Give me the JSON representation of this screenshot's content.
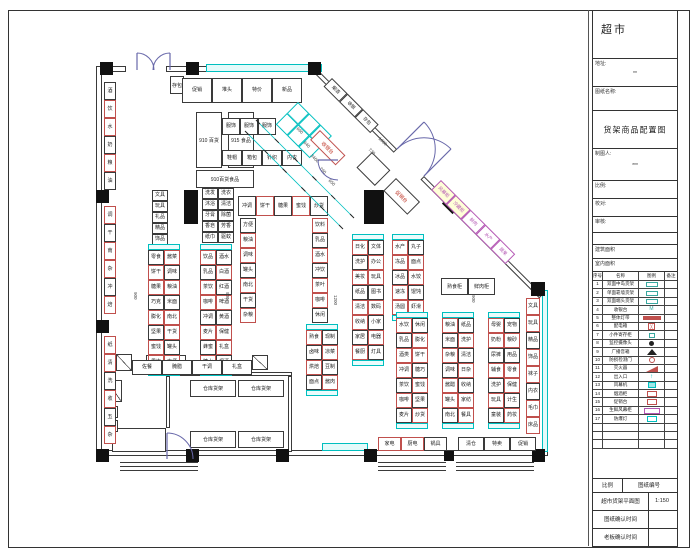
{
  "colors": {
    "black_line": "#3a3a3a",
    "red_line": "#c0504d",
    "cyan_line": "#00bfbf",
    "magenta_line": "#b457b4",
    "door_arc": "#6868aa",
    "red_text": "#c0392b",
    "yellow_fill": "#ffffd8"
  },
  "title_block": {
    "title": "超市",
    "addr_label": "地址:",
    "addr_value": "**",
    "name_label": "图纸名称:",
    "main_title": "货架商品配置图",
    "maker_label": "制图人:",
    "maker_value": "***",
    "scale_label": "比例:",
    "proof_label": "校对:",
    "audit_label": "审核:",
    "area1_label": "建筑面积",
    "area2_label": "室内面积",
    "legend_header": [
      "序号",
      "名称",
      "图例",
      "备注"
    ],
    "legend_rows": [
      {
        "no": "1",
        "name": "双面中岛货架",
        "sym": "trect",
        "note": ""
      },
      {
        "no": "2",
        "name": "单面靠墙货架",
        "sym": "trect",
        "note": ""
      },
      {
        "no": "3",
        "name": "双面端头货架",
        "sym": "trect",
        "note": ""
      },
      {
        "no": "4",
        "name": "收银台",
        "sym": "tword",
        "note": ""
      },
      {
        "no": "5",
        "name": "整体灯带",
        "sym": "rbar",
        "note": ""
      },
      {
        "no": "6",
        "name": "配电箱",
        "sym": "rgrid",
        "note": ""
      },
      {
        "no": "7",
        "name": "小件寄存柜",
        "sym": "tglyph",
        "note": ""
      },
      {
        "no": "8",
        "name": "监控摄像头",
        "sym": "dot",
        "note": ""
      },
      {
        "no": "9",
        "name": "广播音箱",
        "sym": "tri",
        "note": ""
      },
      {
        "no": "10",
        "name": "防损检测门",
        "sym": "rcirc",
        "note": ""
      },
      {
        "no": "11",
        "name": "灭火器",
        "sym": "rflag",
        "note": ""
      },
      {
        "no": "12",
        "name": "出入口",
        "sym": "carrow",
        "note": ""
      },
      {
        "no": "13",
        "name": "风幕机",
        "sym": "cfill",
        "note": ""
      },
      {
        "no": "14",
        "name": "烟酒柜",
        "sym": "rrect",
        "note": ""
      },
      {
        "no": "15",
        "name": "促销台",
        "sym": "rrect",
        "note": ""
      },
      {
        "no": "16",
        "name": "生鲜风幕柜",
        "sym": "mrect",
        "note": ""
      },
      {
        "no": "17",
        "name": "防爆灯",
        "sym": "crect",
        "note": ""
      },
      {
        "no": "",
        "name": "",
        "sym": "none",
        "note": ""
      },
      {
        "no": "",
        "name": "",
        "sym": "none",
        "note": ""
      },
      {
        "no": "",
        "name": "",
        "sym": "none",
        "note": ""
      }
    ],
    "footer_rows": [
      {
        "cells": [
          "比例",
          "图纸编号"
        ],
        "h": 14,
        "split": 30
      },
      {
        "cells": [
          "超市货架平面图",
          "1:150"
        ],
        "h": 18,
        "split": 56
      },
      {
        "cells": [
          "图纸确认时间",
          ""
        ],
        "h": 18,
        "split": 56
      },
      {
        "cells": [
          "老板确认时间",
          ""
        ],
        "h": 18,
        "split": 56
      }
    ]
  },
  "plan": {
    "walls": [
      {
        "x": 100,
        "y": 66,
        "w": 26,
        "h": 6
      },
      {
        "x": 166,
        "y": 66,
        "w": 156,
        "h": 6
      },
      {
        "x": 96,
        "y": 66,
        "w": 6,
        "h": 396
      },
      {
        "x": 96,
        "y": 450,
        "w": 452,
        "h": 6
      },
      {
        "x": 168,
        "y": 372,
        "w": 124,
        "h": 4
      },
      {
        "x": 166,
        "y": 376,
        "w": 4,
        "h": 52
      },
      {
        "x": 288,
        "y": 376,
        "w": 4,
        "h": 76
      },
      {
        "x": 112,
        "y": 428,
        "w": 54,
        "h": 24
      }
    ],
    "cyan_walls": [
      {
        "x": 206,
        "y": 64,
        "w": 116,
        "h": 8
      },
      {
        "x": 542,
        "y": 290,
        "w": 6,
        "h": 162
      },
      {
        "x": 322,
        "y": 443,
        "w": 46,
        "h": 8
      }
    ],
    "diag_walls": [
      {
        "x": 318,
        "y": 70,
        "len": 112,
        "th": 5,
        "rot": 45
      },
      {
        "x": 424,
        "y": 176,
        "len": 168,
        "th": 5,
        "rot": 45
      }
    ],
    "columns": [
      {
        "x": 100,
        "y": 62,
        "s": 13
      },
      {
        "x": 186,
        "y": 62,
        "s": 13
      },
      {
        "x": 308,
        "y": 62,
        "s": 13
      },
      {
        "x": 96,
        "y": 190,
        "s": 13
      },
      {
        "x": 96,
        "y": 320,
        "s": 13
      },
      {
        "x": 96,
        "y": 449,
        "s": 13
      },
      {
        "x": 186,
        "y": 449,
        "s": 13
      },
      {
        "x": 276,
        "y": 449,
        "s": 13
      },
      {
        "x": 364,
        "y": 449,
        "s": 13
      },
      {
        "x": 444,
        "y": 451,
        "s": 10
      },
      {
        "x": 532,
        "y": 449,
        "s": 13
      },
      {
        "x": 531,
        "y": 282,
        "s": 14
      }
    ],
    "diamonds": [
      {
        "x": 445,
        "y": 196,
        "s": 15
      }
    ],
    "pillars": [
      {
        "x": 184,
        "y": 190,
        "w": 14,
        "h": 34
      },
      {
        "x": 364,
        "y": 190,
        "w": 20,
        "h": 34
      }
    ],
    "boxes": [
      {
        "x": 196,
        "y": 112,
        "w": 26,
        "h": 56,
        "t": "910 百货",
        "b": "k"
      },
      {
        "x": 228,
        "y": 112,
        "w": 26,
        "h": 56,
        "t": "915 食品",
        "b": "k"
      },
      {
        "x": 196,
        "y": 170,
        "w": 58,
        "h": 18,
        "t": "910百货食品",
        "b": "k"
      },
      {
        "x": 170,
        "y": 76,
        "w": 14,
        "h": 18,
        "t": "存包",
        "b": "k"
      },
      {
        "x": 190,
        "y": 380,
        "w": 46,
        "h": 17,
        "t": "仓库货架",
        "b": "k"
      },
      {
        "x": 238,
        "y": 380,
        "w": 46,
        "h": 17,
        "t": "仓库货架",
        "b": "k"
      },
      {
        "x": 190,
        "y": 431,
        "w": 46,
        "h": 17,
        "t": "仓库货架",
        "b": "k"
      },
      {
        "x": 238,
        "y": 431,
        "w": 46,
        "h": 17,
        "t": "仓库货架",
        "b": "k"
      },
      {
        "x": 441,
        "y": 278,
        "w": 27,
        "h": 17,
        "t": "熟食柜",
        "b": "k"
      },
      {
        "x": 468,
        "y": 278,
        "w": 27,
        "h": 17,
        "t": "鲜肉柜",
        "b": "k"
      },
      {
        "x": 146,
        "y": 355,
        "w": 40,
        "h": 15,
        "t": "操作台",
        "b": "k"
      },
      {
        "x": 104,
        "y": 406,
        "w": 14,
        "h": 12,
        "t": "",
        "b": "k"
      },
      {
        "x": 104,
        "y": 420,
        "w": 14,
        "h": 12,
        "t": "",
        "b": "k"
      }
    ],
    "xboxes": [
      {
        "x": 116,
        "y": 354,
        "w": 16,
        "h": 17
      },
      {
        "x": 106,
        "y": 380,
        "w": 16,
        "h": 22
      },
      {
        "x": 252,
        "y": 355,
        "w": 16,
        "h": 15
      }
    ],
    "runs": [
      {
        "x": 104,
        "y": 82,
        "d": "v",
        "cw": 12,
        "ch": 18,
        "l": [
          "酒",
          "饮",
          "水",
          "奶",
          "粮",
          "油"
        ],
        "k": "krrkrk"
      },
      {
        "x": 104,
        "y": 206,
        "d": "v",
        "cw": 12,
        "ch": 18,
        "l": [
          "调",
          "干",
          "南",
          "杂",
          "冲",
          "焙"
        ],
        "k": "rkrrkr"
      },
      {
        "x": 104,
        "y": 336,
        "d": "v",
        "cw": 12,
        "ch": 18,
        "l": [
          "纸",
          "清",
          "洗",
          "收",
          "五",
          "杂"
        ],
        "k": "rrkrkr"
      },
      {
        "x": 526,
        "y": 298,
        "d": "v",
        "cw": 14,
        "ch": 17,
        "l": [
          "文具",
          "玩具",
          "精品",
          "饰品",
          "袜子",
          "内衣",
          "毛巾",
          "床品"
        ],
        "k": "rrkrrkrr"
      },
      {
        "x": 182,
        "y": 78,
        "d": "h",
        "cw": 30,
        "ch": 25,
        "l": [
          "促销",
          "堆头",
          "特价",
          "新品"
        ],
        "k": "kkkk"
      },
      {
        "x": 222,
        "y": 118,
        "d": "h",
        "cw": 18,
        "ch": 17,
        "l": [
          "服饰",
          "服饰",
          "服饰"
        ],
        "k": "kkk"
      },
      {
        "x": 222,
        "y": 150,
        "d": "h",
        "cw": 20,
        "ch": 16,
        "l": [
          "鞋帽",
          "箱包",
          "针织",
          "内衣"
        ],
        "k": "kkkk"
      },
      {
        "x": 152,
        "y": 190,
        "d": "v",
        "cw": 16,
        "ch": 11,
        "l": [
          "文具",
          "玩具",
          "礼品",
          "精品",
          "饰品"
        ],
        "k": "kkkkk"
      },
      {
        "x": 202,
        "y": 188,
        "d": "v",
        "cw": 16,
        "ch": 11,
        "l": [
          "洗发",
          "沐浴",
          "牙膏",
          "香皂",
          "纸巾"
        ],
        "k": "kkkkk"
      },
      {
        "x": 218,
        "y": 188,
        "d": "v",
        "cw": 16,
        "ch": 11,
        "l": [
          "洗衣",
          "清洁",
          "除菌",
          "芳香",
          "驱蚊"
        ],
        "k": "kkkkk"
      },
      {
        "x": 238,
        "y": 196,
        "d": "h",
        "cw": 18,
        "ch": 20,
        "l": [
          "冲调",
          "饼干",
          "糖果",
          "蜜饯",
          "炒货"
        ],
        "k": "krkrk"
      },
      {
        "x": 240,
        "y": 218,
        "d": "v",
        "cw": 16,
        "ch": 15,
        "l": [
          "方便",
          "粮油",
          "调味",
          "罐头",
          "南北",
          "干货",
          "杂粮"
        ],
        "k": "krrkrkr"
      },
      {
        "x": 312,
        "y": 218,
        "d": "v",
        "cw": 16,
        "ch": 15,
        "l": [
          "饮料",
          "乳品",
          "酒水",
          "冲饮",
          "茶叶",
          "咖啡",
          "休闲"
        ],
        "k": "rkrkrrk"
      },
      {
        "x": 148,
        "y": 250,
        "d": "v",
        "cw": 16,
        "ch": 15,
        "capW": 32,
        "l": [
          "零食",
          "饼干",
          "糖果",
          "巧克",
          "膨化",
          "坚果",
          "蜜饯",
          "果冻"
        ],
        "k": "krrkrkrr"
      },
      {
        "x": 164,
        "y": 250,
        "d": "v",
        "cw": 16,
        "ch": 15,
        "l": [
          "酱菜",
          "调味",
          "粮油",
          "米面",
          "南北",
          "干货",
          "罐头",
          "方便"
        ],
        "k": "rkrkrrkr"
      },
      {
        "x": 200,
        "y": 250,
        "d": "v",
        "cw": 16,
        "ch": 15,
        "capW": 32,
        "l": [
          "饮品",
          "乳品",
          "茶饮",
          "咖啡",
          "冲调",
          "麦片",
          "蜂蜜",
          "糖水"
        ],
        "k": "rkrrkrkr"
      },
      {
        "x": 216,
        "y": 250,
        "d": "v",
        "cw": 16,
        "ch": 15,
        "l": [
          "酒水",
          "白酒",
          "红酒",
          "啤酒",
          "黄酒",
          "保健",
          "礼盒",
          "烟酒"
        ],
        "k": "krkrkrrk"
      },
      {
        "x": 352,
        "y": 240,
        "d": "v",
        "cw": 16,
        "ch": 15,
        "capW": 32,
        "l": [
          "日化",
          "洗护",
          "美妆",
          "纸品",
          "清洁",
          "收纳",
          "家居",
          "餐厨"
        ],
        "k": "rkrkrrkr"
      },
      {
        "x": 368,
        "y": 240,
        "d": "v",
        "cw": 16,
        "ch": 15,
        "l": [
          "文体",
          "办公",
          "玩具",
          "图书",
          "数码",
          "小家",
          "电器",
          "灯具"
        ],
        "k": "krrkrkrk"
      },
      {
        "x": 392,
        "y": 240,
        "d": "v",
        "cw": 16,
        "ch": 15,
        "capW": 32,
        "l": [
          "水产",
          "冻品",
          "冰品",
          "速冻",
          "汤圆"
        ],
        "k": "rrkrr"
      },
      {
        "x": 408,
        "y": 240,
        "d": "v",
        "cw": 16,
        "ch": 15,
        "l": [
          "丸子",
          "面点",
          "水饺",
          "馄饨",
          "虾滑"
        ],
        "k": "krrkr"
      },
      {
        "x": 306,
        "y": 330,
        "d": "v",
        "cw": 16,
        "ch": 15,
        "capW": 32,
        "l": [
          "熟食",
          "卤味",
          "烘焙",
          "面点"
        ],
        "k": "rkrk"
      },
      {
        "x": 322,
        "y": 330,
        "d": "v",
        "cw": 16,
        "ch": 15,
        "l": [
          "现制",
          "凉菜",
          "豆制",
          "酱肉"
        ],
        "k": "krkr"
      },
      {
        "x": 396,
        "y": 318,
        "d": "v",
        "cw": 16,
        "ch": 15,
        "capW": 32,
        "l": [
          "水饮",
          "乳品",
          "酒类",
          "冲调",
          "茶饮",
          "咖啡",
          "麦片"
        ],
        "k": "rkrrkrk"
      },
      {
        "x": 412,
        "y": 318,
        "d": "v",
        "cw": 16,
        "ch": 15,
        "l": [
          "休闲",
          "膨化",
          "饼干",
          "糖巧",
          "蜜饯",
          "坚果",
          "炒货"
        ],
        "k": "krrkrkr"
      },
      {
        "x": 442,
        "y": 318,
        "d": "v",
        "cw": 16,
        "ch": 15,
        "capW": 32,
        "l": [
          "粮油",
          "米面",
          "杂粮",
          "调味",
          "酱醋",
          "罐头",
          "南北"
        ],
        "k": "rkrkrrk"
      },
      {
        "x": 458,
        "y": 318,
        "d": "v",
        "cw": 16,
        "ch": 15,
        "l": [
          "纸品",
          "洗护",
          "清洁",
          "日杂",
          "收纳",
          "家纺",
          "餐具"
        ],
        "k": "krkrkrr"
      },
      {
        "x": 488,
        "y": 318,
        "d": "v",
        "cw": 16,
        "ch": 15,
        "capW": 32,
        "l": [
          "母婴",
          "奶粉",
          "尿裤",
          "辅食",
          "洗护",
          "玩具",
          "童装"
        ],
        "k": "rrkrkrk"
      },
      {
        "x": 504,
        "y": 318,
        "d": "v",
        "cw": 16,
        "ch": 15,
        "l": [
          "宠物",
          "粮砂",
          "用品",
          "零食",
          "保健",
          "计生",
          "药妆"
        ],
        "k": "krkrrkr"
      },
      {
        "x": 132,
        "y": 360,
        "d": "h",
        "cw": 30,
        "ch": 15,
        "l": [
          "佐餐",
          "腌腊",
          "干调",
          "礼盒"
        ],
        "k": "kkkk"
      },
      {
        "x": 378,
        "y": 437,
        "d": "h",
        "cw": 23,
        "ch": 14,
        "l": [
          "家电",
          "厨电",
          "锅具"
        ],
        "k": "rrk"
      },
      {
        "x": 458,
        "y": 437,
        "d": "h",
        "cw": 26,
        "ch": 14,
        "l": [
          "清仓",
          "特卖",
          "促销"
        ],
        "k": "kkk"
      }
    ],
    "rot_runs": [
      {
        "x": 298,
        "y": 102,
        "cw": 16,
        "ch": 16,
        "l": [
          "",
          "",
          ""
        ],
        "k": "ccc"
      },
      {
        "x": 287,
        "y": 113,
        "cw": 16,
        "ch": 16,
        "l": [
          "",
          "",
          ""
        ],
        "k": "ccc"
      },
      {
        "x": 332,
        "y": 78,
        "cw": 22,
        "ch": 12,
        "l": [
          "烟酒",
          "收银",
          "存包"
        ],
        "k": "kkk"
      },
      {
        "x": 441,
        "y": 180,
        "cw": 21,
        "ch": 14,
        "l": [
          "风幕柜",
          "冷藏柜",
          "鲜肉",
          "水产",
          "蔬果"
        ],
        "k": "mmmmm",
        "tc": "m",
        "fills": [
          1,
          1,
          0,
          0,
          0
        ]
      }
    ],
    "rot_boxes": [
      {
        "x": 320,
        "y": 130,
        "w": 36,
        "h": 14,
        "t": "收银台",
        "b": "r",
        "tc": "r"
      },
      {
        "x": 396,
        "y": 178,
        "w": 34,
        "h": 18,
        "t": "促销台",
        "b": "k",
        "tc": "r"
      },
      {
        "x": 372,
        "y": 152,
        "w": 26,
        "h": 22,
        "t": "",
        "b": "k"
      }
    ],
    "dims": [
      {
        "x": 299,
        "y": 126,
        "t": "660",
        "rot": 45
      },
      {
        "x": 306,
        "y": 140,
        "t": "640",
        "rot": 45
      },
      {
        "x": 313,
        "y": 153,
        "t": "3460",
        "rot": 45
      },
      {
        "x": 322,
        "y": 166,
        "t": "760",
        "rot": 45
      },
      {
        "x": 331,
        "y": 178,
        "t": "650",
        "rot": 45
      },
      {
        "x": 371,
        "y": 147,
        "t": "730",
        "rot": 45
      },
      {
        "x": 381,
        "y": 136,
        "t": "1060",
        "rot": 45
      },
      {
        "x": 138,
        "y": 292,
        "t": "900",
        "rot": 90
      },
      {
        "x": 230,
        "y": 292,
        "t": "900",
        "rot": 90
      },
      {
        "x": 338,
        "y": 295,
        "t": "1200",
        "rot": 90
      },
      {
        "x": 476,
        "y": 295,
        "t": "900",
        "rot": 90
      }
    ],
    "dimlines": [
      {
        "x1": 258,
        "y1": 122,
        "x2": 352,
        "y2": 216
      },
      {
        "x1": 247,
        "y1": 133,
        "x2": 341,
        "y2": 227
      }
    ],
    "arcs": [
      {
        "x1": 137,
        "y1": 53,
        "x2": 154,
        "y2": 70,
        "r": 17,
        "sw": 1
      },
      {
        "x1": 170,
        "y1": 53,
        "x2": 153,
        "y2": 70,
        "r": 17,
        "sw": 0
      },
      {
        "x1": 424,
        "y1": 176,
        "x2": 424,
        "y2": 122,
        "r": 38,
        "sw": 0
      },
      {
        "x1": 397,
        "y1": 149,
        "x2": 451,
        "y2": 149,
        "r": 38,
        "sw": 1
      },
      {
        "x1": 318,
        "y1": 160,
        "x2": 338,
        "y2": 180,
        "r": 20,
        "sw": 0
      },
      {
        "x1": 167,
        "y1": 433,
        "x2": 193,
        "y2": 459,
        "r": 26,
        "sw": 1
      }
    ],
    "leaves": [
      [
        137,
        70,
        137,
        53
      ],
      [
        170,
        70,
        170,
        53
      ],
      [
        397,
        149,
        424,
        122
      ],
      [
        424,
        176,
        451,
        149
      ],
      [
        167,
        433,
        167,
        459
      ],
      [
        338,
        160,
        318,
        160
      ]
    ],
    "steps": [
      {
        "x": 120,
        "w": 78,
        "ys": [
          462,
          466,
          470
        ]
      },
      {
        "x": 378,
        "w": 68,
        "ys": [
          462,
          466,
          470
        ]
      },
      {
        "x": 456,
        "w": 78,
        "ys": [
          462,
          466,
          470
        ]
      }
    ]
  }
}
